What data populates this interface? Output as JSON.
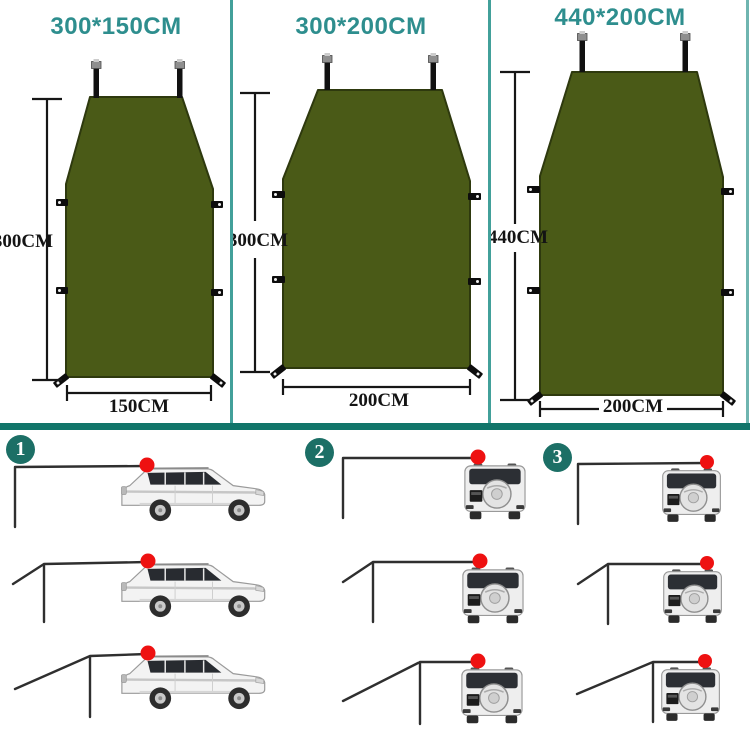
{
  "colors": {
    "title_teal": "#2e8e8e",
    "divider_teal": "#42a09a",
    "band_teal": "#11756a",
    "badge_teal": "#1c6f66",
    "tarp_green": "#4a5a17",
    "red_marker": "#ee1111"
  },
  "size_panels": [
    {
      "title": "300*150CM",
      "height_label": "300CM",
      "width_label": "150CM"
    },
    {
      "title": "300*200CM",
      "height_label": "300CM",
      "width_label": "200CM"
    },
    {
      "title": "440*200CM",
      "height_label": "440CM",
      "width_label": "200CM"
    }
  ],
  "setup_steps": [
    {
      "number": "1"
    },
    {
      "number": "2"
    },
    {
      "number": "3"
    }
  ]
}
